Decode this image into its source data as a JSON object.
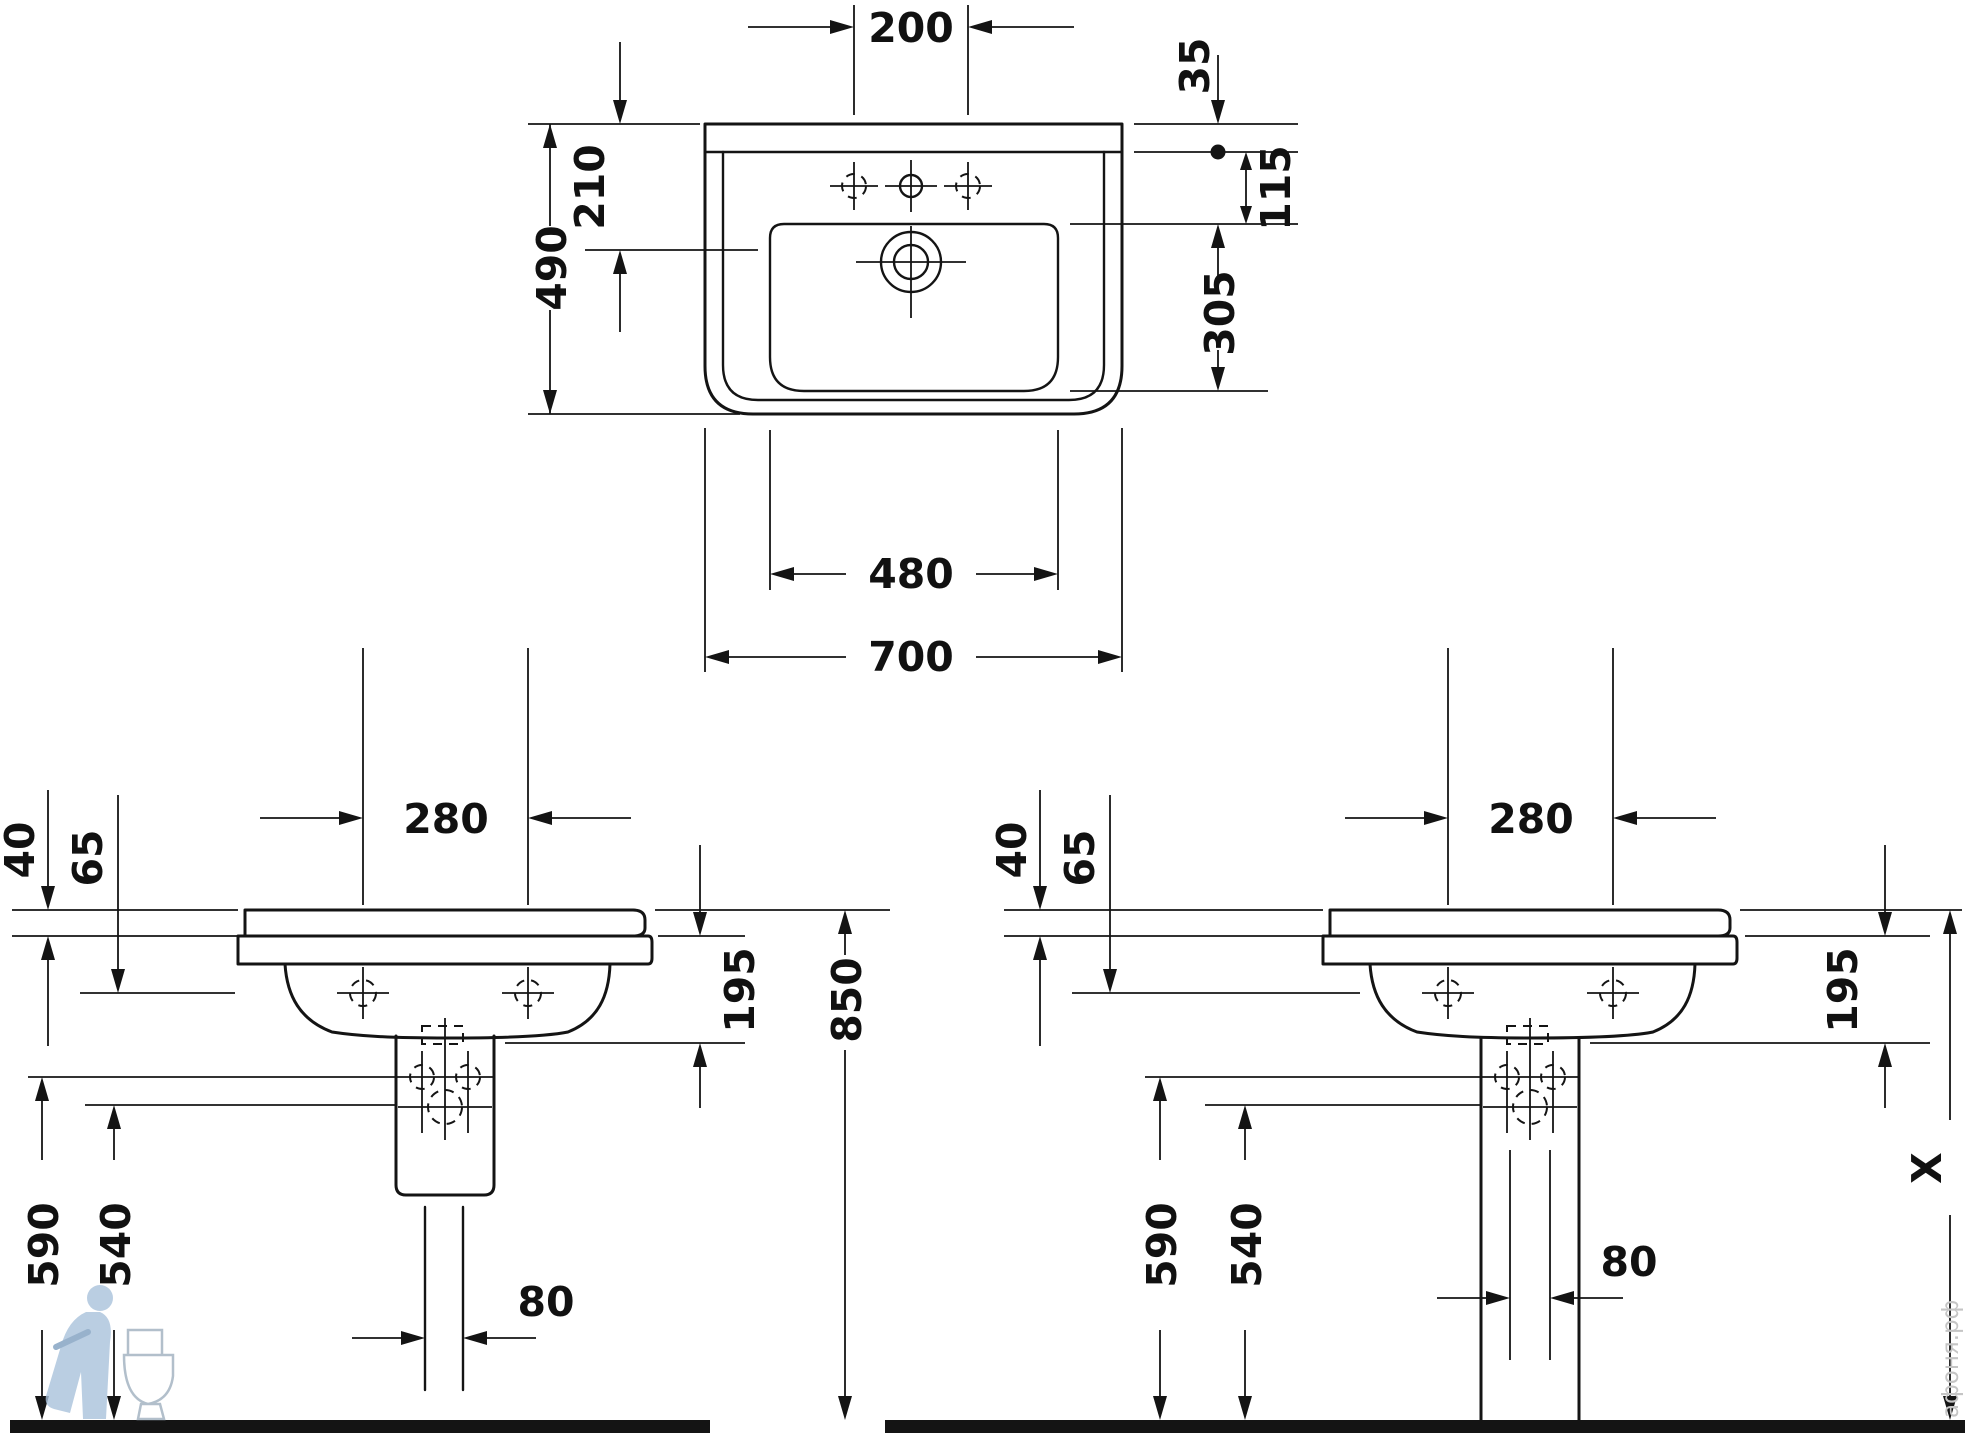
{
  "drawing": {
    "kind": "washbasin technical dimension drawing",
    "views": [
      "plan",
      "side with siphon cover",
      "side with full pedestal"
    ]
  },
  "dims": {
    "top": {
      "d200": "200",
      "d35": "35",
      "d115": "115",
      "d305": "305",
      "d490": "490",
      "d210": "210",
      "d480": "480",
      "d700": "700"
    },
    "left": {
      "d40": "40",
      "d65": "65",
      "d280": "280",
      "d195": "195",
      "d850": "850",
      "d590": "590",
      "d540": "540",
      "d80": "80"
    },
    "right": {
      "d40": "40",
      "d65": "65",
      "d280": "280",
      "d195": "195",
      "dX": "X",
      "d590": "590",
      "d540": "540",
      "d80": "80"
    }
  },
  "watermark": {
    "site_text": "афоня.рф"
  },
  "colors": {
    "line": "#141414",
    "background": "#ffffff",
    "watermark_blue": "#a9c2dc",
    "watermark_gray": "#c5c5c5"
  }
}
